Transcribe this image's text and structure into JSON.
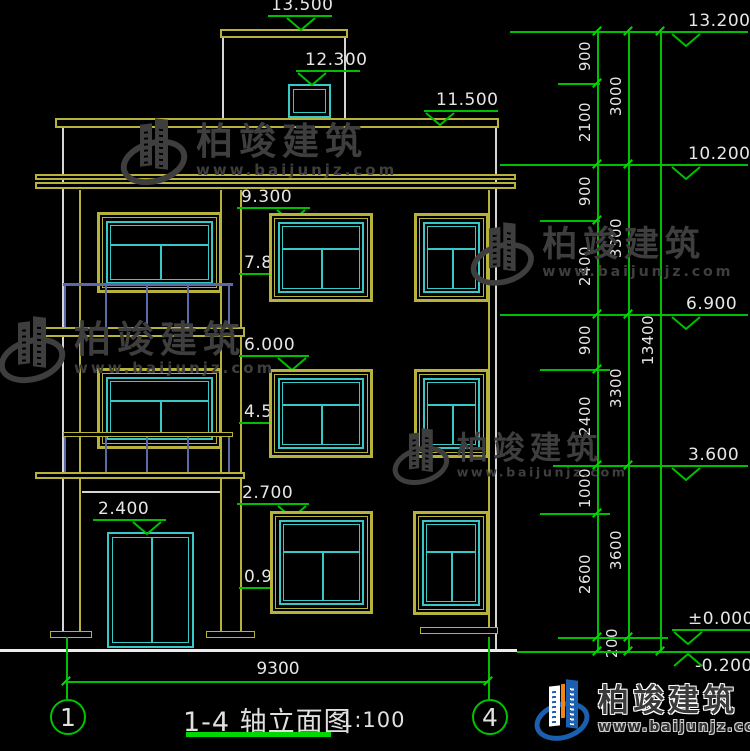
{
  "watermark": {
    "brand": "柏竣建筑",
    "url": "www.baijunjz.com"
  },
  "logo": {
    "brand": "柏竣建筑",
    "url": "www.baijunjz.com"
  },
  "title_block": {
    "title": "1-4 轴立面图",
    "scale": "1:100",
    "axis_left": "1",
    "axis_right": "4"
  },
  "dimensions": {
    "overall_width": "9300",
    "col1": [
      "900",
      "2100",
      "900",
      "2400",
      "900",
      "2400",
      "1000",
      "2600",
      "200"
    ],
    "col2": [
      "3000",
      "3300",
      "3300",
      "3600"
    ],
    "col3": [
      "13400"
    ]
  },
  "elevations_left": [
    "13.500",
    "12.300",
    "11.500",
    "9.300",
    "7.870",
    "7.800",
    "6.000",
    "4.570",
    "4.500",
    "2.700",
    "2.400",
    "0.900"
  ],
  "elevations_right": [
    "13.200",
    "10.200",
    "6.900",
    "3.600",
    "±0.000",
    "-0.200"
  ]
}
